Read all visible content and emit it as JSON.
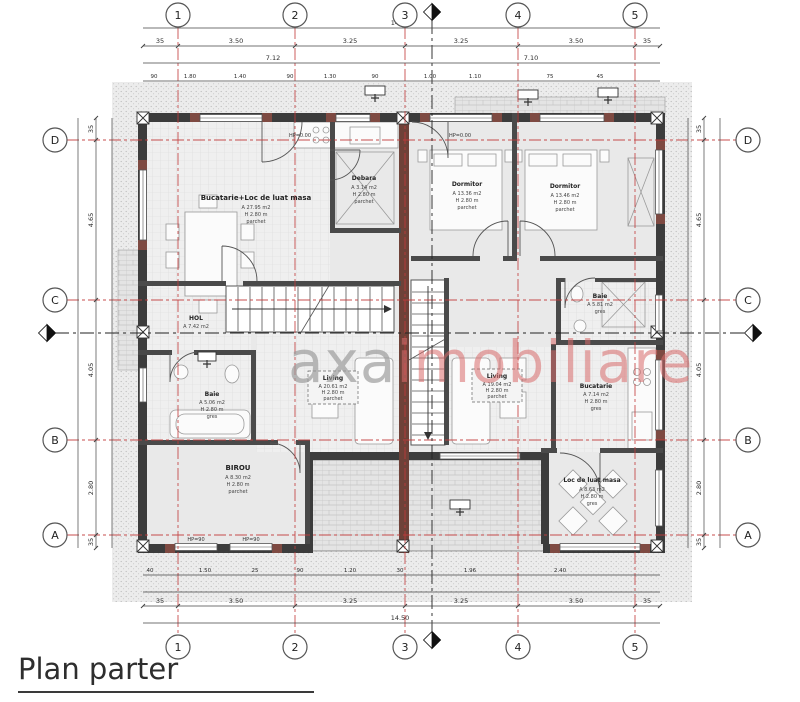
{
  "title": "Plan parter",
  "watermark": {
    "gray": "axa",
    "red": "imobiliare"
  },
  "axes": {
    "top": [
      "1",
      "2",
      "3",
      "4",
      "5"
    ],
    "bottom": [
      "1",
      "2",
      "3",
      "4",
      "5"
    ],
    "left": [
      "D",
      "C",
      "B",
      "A"
    ],
    "right": [
      "D",
      "C",
      "B",
      "A"
    ]
  },
  "rooms": [
    {
      "name": "Bucatarie+Loc de luat masa",
      "area": "A 27.95 m2",
      "height": "H 2.80 m",
      "floor": "parchet"
    },
    {
      "name": "Debara",
      "area": "A 3.14 m2",
      "height": "H 2.80 m",
      "floor": "parchet"
    },
    {
      "name": "Dormitor",
      "area": "A 13.36 m2",
      "height": "H 2.80 m",
      "floor": "parchet"
    },
    {
      "name": "Dormitor",
      "area": "A 13.46 m2",
      "height": "H 2.80 m",
      "floor": "parchet"
    },
    {
      "name": "HOL",
      "area": "A 7.42 m2",
      "height": "H 2.80 m",
      "floor": "parchet"
    },
    {
      "name": "Baie",
      "area": "A 5.06 m2",
      "height": "H 2.80 m",
      "floor": "gres"
    },
    {
      "name": "Living",
      "area": "A 20.61 m2",
      "height": "H 2.80 m",
      "floor": "parchet"
    },
    {
      "name": "Living",
      "area": "A 19.04 m2",
      "height": "H 2.80 m",
      "floor": "parchet"
    },
    {
      "name": "Baie",
      "area": "A 5.81 m2",
      "height": "H 2.80 m",
      "floor": "gres"
    },
    {
      "name": "Bucatarie",
      "area": "A 7.14 m2",
      "height": "H 2.80 m",
      "floor": "gres"
    },
    {
      "name": "BIROU",
      "area": "A 8.30 m2",
      "height": "H 2.80 m",
      "floor": "parchet"
    },
    {
      "name": "Loc de luat masa",
      "area": "A 8.63 m2",
      "height": "H 2.80 m",
      "floor": "gres"
    }
  ],
  "dimensions": {
    "overall_top": "14.50",
    "overall_bottom": "14.50",
    "top_segments": [
      "35",
      "3.50",
      "3.25",
      "3.25",
      "3.50",
      "35"
    ],
    "top_mid": [
      "7.12",
      "7.10"
    ],
    "top_small": [
      "90",
      "1.80",
      "1.40",
      "90",
      "1.30",
      "90",
      "1.00",
      "1.10",
      "75",
      "45"
    ],
    "bottom_segments": [
      "35",
      "3.50",
      "3.25",
      "3.25",
      "3.50",
      "35"
    ],
    "bottom_small": [
      "40",
      "1.50",
      "25",
      "90",
      "1.20",
      "30",
      "1.96",
      "2.40"
    ],
    "left_segments": [
      "35",
      "4.65",
      "4.05",
      "2.80",
      "35"
    ],
    "right_segments": [
      "35",
      "4.65",
      "4.05",
      "2.80",
      "35"
    ],
    "hp_zero": "HP=0.00",
    "hp_ninety": "HP=90"
  }
}
